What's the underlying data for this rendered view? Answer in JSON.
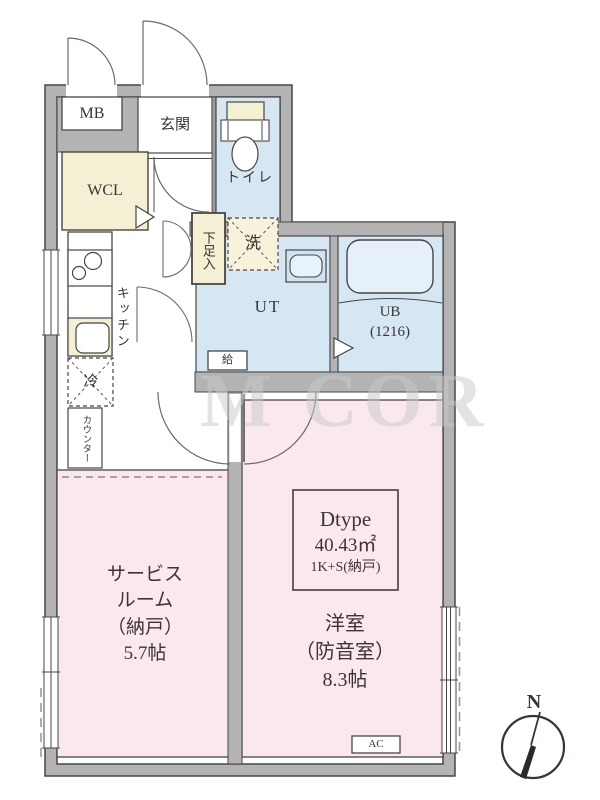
{
  "labels": {
    "mb": "MB",
    "entrance": "玄関",
    "toilet": "トイレ",
    "wcl": "WCL",
    "shoe_cabinet": "下足入",
    "washer": "洗",
    "kitchen": "キッチン",
    "utility": "UT",
    "bath_line1": "UB",
    "bath_line2": "(1216)",
    "water_supply": "給",
    "refrigerator": "冷",
    "counter": "カウンター",
    "service_room_line1": "サービス",
    "service_room_line2": "ルーム",
    "service_room_line3": "（納戸）",
    "service_room_line4": "5.7帖",
    "unit_type": "Dtype",
    "unit_area": "40.43㎡",
    "unit_layout": "1K+S(納戸)",
    "western_room_line1": "洋室",
    "western_room_line2": "（防音室）",
    "western_room_line3": "8.3帖",
    "ac": "AC",
    "north": "N"
  },
  "watermark": "M COR",
  "colors": {
    "room_pink": "#fbe8ef",
    "wet_area_blue": "#d6e7f4",
    "closet_cream": "#f4f0d3",
    "wall_gray": "#b3b3b3",
    "line_dark": "#4a4544"
  }
}
